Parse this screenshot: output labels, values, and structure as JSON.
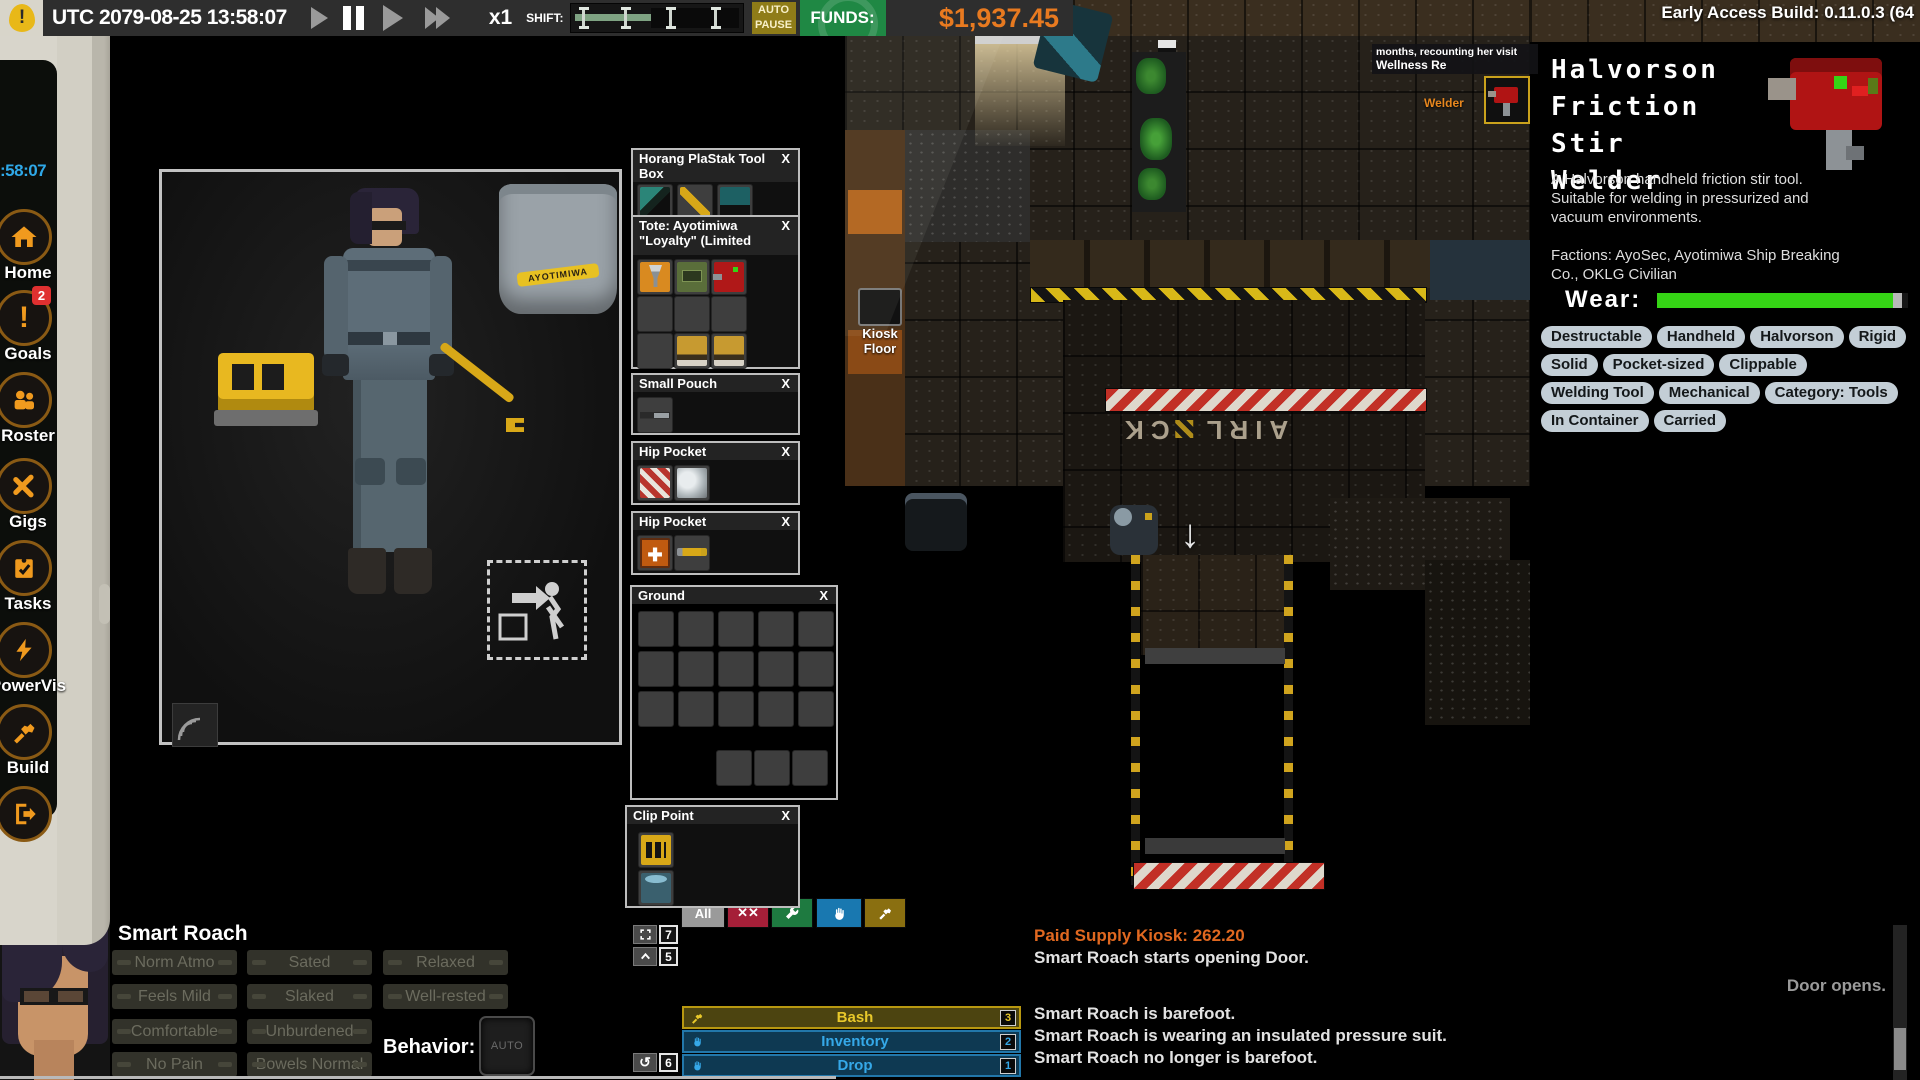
{
  "top_bar": {
    "time": "UTC 2079-08-25 13:58:07",
    "speed": "x1",
    "shift_label": "SHIFT:",
    "auto_pause": "AUTO PAUSE",
    "funds_label": "FUNDS:",
    "funds_value": "$1,937.45",
    "build": "Early Access Build: 0.11.0.3 (64"
  },
  "sidebar": {
    "clock": ":58:07",
    "items": [
      {
        "label": "Home"
      },
      {
        "label": "Goals",
        "badge": "2"
      },
      {
        "label": "Roster"
      },
      {
        "label": "Gigs"
      },
      {
        "label": "Tasks"
      },
      {
        "label": "PowerVis"
      },
      {
        "label": "Build"
      }
    ]
  },
  "character_window": {
    "tote_brand": "AYOTIMIWA"
  },
  "inventory": {
    "containers": [
      {
        "title": "Horang PlaStak Tool Box",
        "close": "X",
        "items": [
          "angle-grinder",
          "pipe-wrench",
          "drill"
        ]
      },
      {
        "title": "Tote: Ayotimiwa \"Loyalty\" (Limited",
        "close": "X",
        "items": [
          "funnel-bag",
          "circuit-meter",
          "stir-welder",
          "work-boot",
          "work-boot"
        ]
      },
      {
        "title": "Small Pouch",
        "close": "X",
        "items": [
          "knife"
        ]
      },
      {
        "title": "Hip Pocket",
        "close": "X",
        "items": [
          "bandage",
          "rags"
        ]
      },
      {
        "title": "Hip Pocket",
        "close": "X",
        "items": [
          "patch-kit",
          "screwdriver"
        ]
      },
      {
        "title": "Ground",
        "close": "X",
        "items": []
      },
      {
        "title": "Clip Point",
        "close": "X",
        "items": [
          "battery-pack",
          "clip-gadget"
        ]
      }
    ],
    "filters": {
      "all": "All",
      "close_all": "✕✕"
    }
  },
  "item_panel": {
    "title": "Halvorson Friction Stir Welder",
    "title_lines": [
      "Halvorson",
      "Friction Stir",
      "Welder"
    ],
    "description": "A Halvorson handheld friction stir tool. Suitable for welding in pressurized and vacuum environments.",
    "factions": "Factions: AyoSec, Ayotimiwa Ship Breaking Co., OKLG Civilian",
    "wear_label": "Wear:",
    "wear_percent": 94,
    "wear_color": "#35d415",
    "tags": [
      "Destructable",
      "Handheld",
      "Halvorson",
      "Rigid",
      "Solid",
      "Pocket-sized",
      "Clippable",
      "Welding Tool",
      "Mechanical",
      "Category: Tools",
      "In Container",
      "Carried"
    ]
  },
  "world": {
    "tooltip_line1": "months, recounting her visit",
    "tooltip_line2": "Wellness Re",
    "welder_label": "Welder",
    "kiosk_label_line1": "Kiosk",
    "kiosk_label_line2": "Floor",
    "airlock_left": "AIRL",
    "airlock_right": "CK",
    "down_arrow": "↓"
  },
  "status_panel": {
    "name": "Smart Roach",
    "statuses": [
      "Norm Atmo",
      "Sated",
      "Relaxed",
      "Feels Mild",
      "Slaked",
      "Well-rested",
      "Comfortable",
      "Unburdened",
      "No Pain",
      "Bowels Normal"
    ],
    "behavior_label": "Behavior:",
    "behavior_value": "AUTO"
  },
  "action_menu": {
    "keybinds": [
      {
        "key": "7",
        "icon": "expand-icon"
      },
      {
        "key": "5",
        "icon": "chevron-up-icon"
      },
      {
        "key": "6",
        "icon": "rotate-icon"
      }
    ],
    "actions": [
      {
        "label": "Bash",
        "key": "3",
        "accent": "#e8c82a"
      },
      {
        "label": "Inventory",
        "key": "2",
        "accent": "#35a8e8"
      },
      {
        "label": "Drop",
        "key": "1",
        "accent": "#35a8e8"
      }
    ],
    "rotate_glyph": "↺"
  },
  "log": {
    "messages": [
      "Paid Supply Kiosk: 262.20",
      "Smart Roach starts opening Door.",
      "Door opens.",
      "Smart Roach is barefoot.",
      "Smart Roach is wearing an insulated pressure suit.",
      "Smart Roach no longer is barefoot."
    ]
  }
}
